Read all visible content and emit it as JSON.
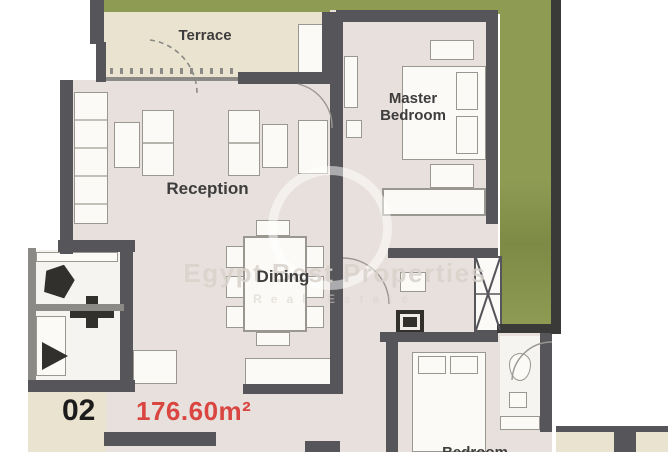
{
  "colors": {
    "wall": "#56565a",
    "wall-dark": "#3a3a38",
    "wall-light": "#8b8a86",
    "green": "#8e9b53",
    "green-dark": "#7d8a45",
    "beige": "#eae3cf",
    "floor": "#e8e0dd",
    "bath-floor": "#f6f4f1",
    "furniture-line": "#9a9690",
    "furniture-fill": "#fbfaf7",
    "fixture-dark": "#32302d",
    "label": "#3e3d3d",
    "unit-number": "#1d1c1c",
    "area-red": "#d94641",
    "watermark": "#d8d2cb"
  },
  "rooms": {
    "terrace": {
      "label": "Terrace"
    },
    "reception": {
      "label": "Reception"
    },
    "master_bedroom": {
      "label": "Master Bedroom"
    },
    "dining": {
      "label": "Dining"
    },
    "bedroom": {
      "label": "Bedroom"
    }
  },
  "unit": {
    "number": "02",
    "area": "176.60m²"
  },
  "watermark": {
    "title": "Egypt Best Properties",
    "subtitle": "Real Estate"
  }
}
